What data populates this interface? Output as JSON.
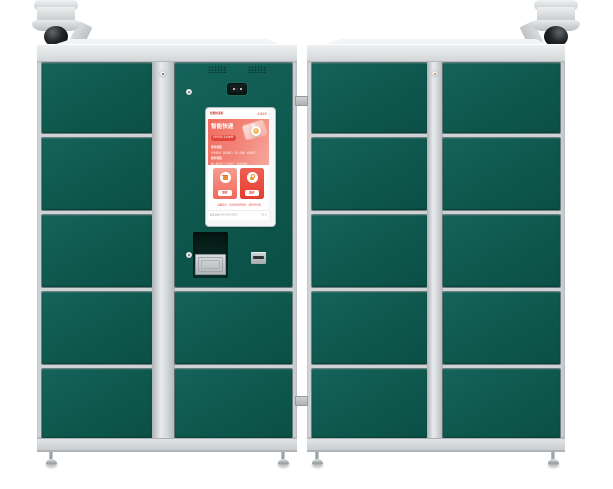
{
  "colors": {
    "door_green": "#0e574d",
    "frame_gray": "#cfd3d5",
    "strip_gray": "#d8dbdd",
    "screen_red": "#e2443a",
    "banner_pink": "#f28679",
    "dome_black": "#0d0f11",
    "icon_orange": "#ec9d33"
  },
  "layout": {
    "door_heights": [
      70,
      72,
      72,
      72,
      69
    ],
    "row_gap": 5,
    "door_rows": 5
  },
  "screen_ui": {
    "header_left": "智能快递柜",
    "header_right": "欢迎使用",
    "banner": {
      "title": "智能快递",
      "pill": "扫码存取 安全便捷",
      "sections": [
        {
          "heading": "寄件流程",
          "items": "扫码登录 · 选择格口 · 存入包裹 · 关闭柜门"
        },
        {
          "heading": "取件流程",
          "items": "输入取件码 · 打开柜门 · 取出包裹"
        }
      ]
    },
    "buttons": [
      {
        "label": "寄件"
      },
      {
        "label": "取件"
      }
    ],
    "note": "温馨提示：请凭取件码取件，超时将计费",
    "footer_left": "服务热线 400-000-0000",
    "footer_right": "V1.0"
  }
}
